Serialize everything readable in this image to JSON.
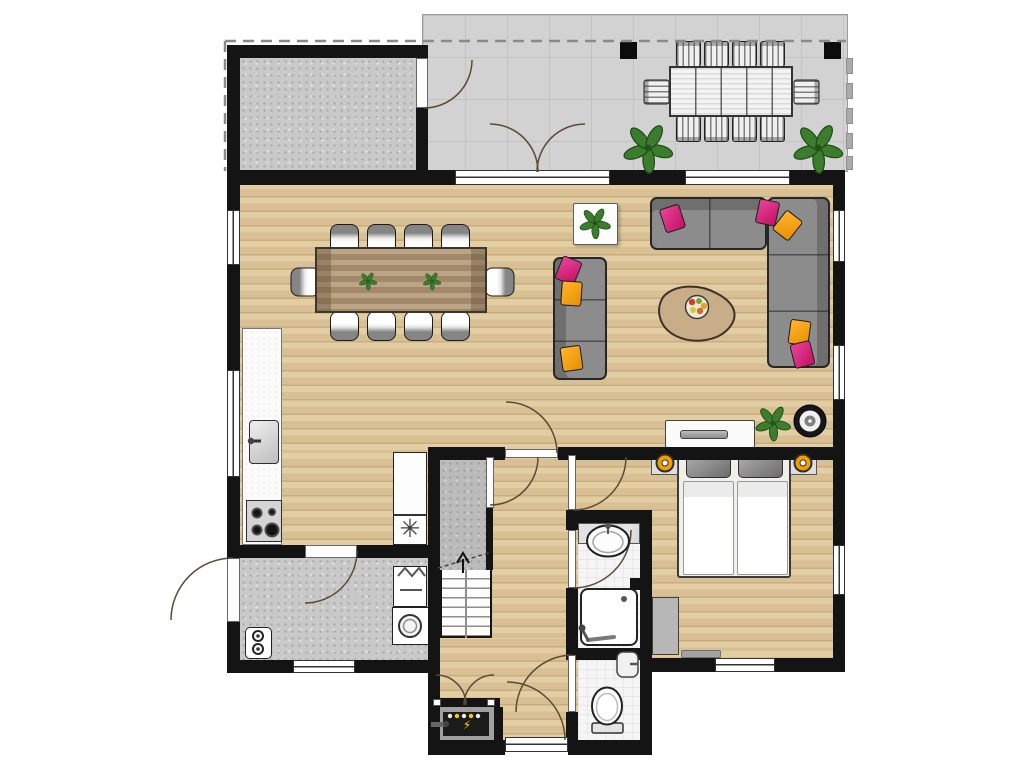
{
  "plan": {
    "type": "residential-ground-floor-plan",
    "symbols": {
      "freezer": "✳",
      "power": "⚡"
    },
    "palette": {
      "wall": "#141414",
      "wood_floor": "#dcc49b",
      "terrace_tile": "#d2d2d2",
      "concrete_floor": "#c9c9c9",
      "bathroom_tile": "#f5f5f5",
      "sofa_gray": "#8c8c8c",
      "cushion_pink": "#d8216e",
      "cushion_orange": "#f2a007",
      "table_wood": "#b09572",
      "plant_green": "#3b7d2c",
      "lamp_orange": "#ef9f00"
    },
    "regions": [
      {
        "name": "terrace",
        "floor": "tile",
        "features": [
          "outdoor-dining-table",
          "10-outdoor-chairs",
          "2-plants",
          "2-posts",
          "fence",
          "dashed-boundary"
        ]
      },
      {
        "name": "storage-room",
        "floor": "concrete",
        "features": [
          "door-to-terrace"
        ]
      },
      {
        "name": "living-dining-room",
        "floor": "wood",
        "features": [
          "dining-table-10-chairs",
          "corner-sofa",
          "two-seat-sofa",
          "coffee-table-with-fruit-bowl",
          "side-table-with-plant",
          "sideboard",
          "speaker",
          "plant"
        ]
      },
      {
        "name": "kitchen",
        "floor": "wood",
        "features": [
          "counter",
          "sink",
          "stove-4-burners",
          "fridge-freezer"
        ]
      },
      {
        "name": "utility-room",
        "floor": "concrete",
        "features": [
          "washing-machine",
          "laundry-basket",
          "water-heater",
          "side-entrance-door"
        ]
      },
      {
        "name": "hall-with-stairs",
        "floor": "wood",
        "features": [
          "staircase-up",
          "meter-cupboard",
          "front-door"
        ]
      },
      {
        "name": "bedroom",
        "floor": "wood",
        "features": [
          "double-bed",
          "2-nightstands",
          "2-lamps",
          "wardrobe",
          "rug"
        ]
      },
      {
        "name": "bathroom",
        "floor": "tile",
        "features": [
          "washbasin",
          "walk-in-shower"
        ]
      },
      {
        "name": "wc",
        "floor": "tile",
        "features": [
          "toilet",
          "hand-basin"
        ]
      }
    ],
    "counts": {
      "outdoor_chairs": 10,
      "indoor_dining_chairs": 10,
      "plants": 6,
      "windows": 9,
      "interior_doors": 7,
      "exterior_doors": 4,
      "stove_burners": 4,
      "scatter_cushions": 8
    }
  }
}
